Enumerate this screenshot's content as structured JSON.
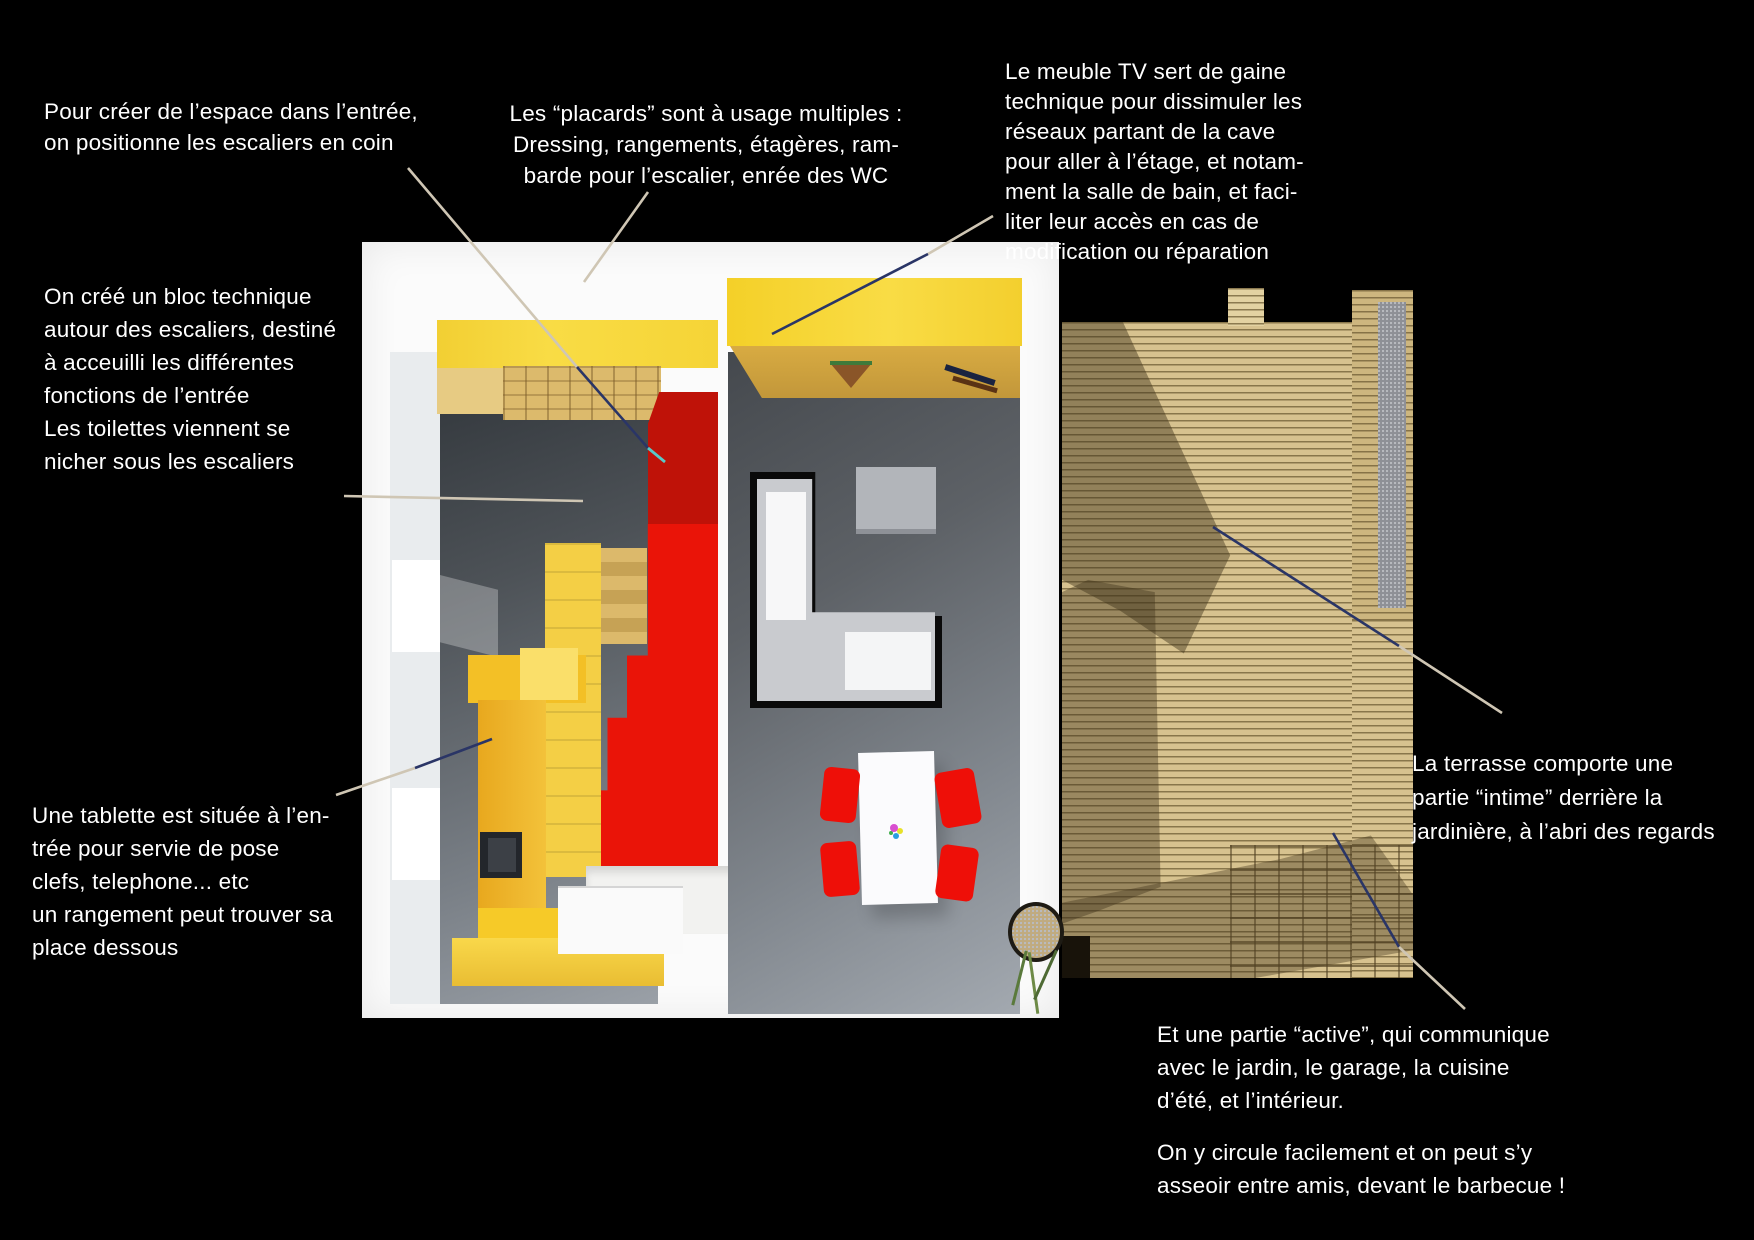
{
  "scene": {
    "description": "3D architectural floor-plan render (entrée, séjour, terrasse) on black background with annotation callouts",
    "background_color": "#000000",
    "annotation_text_color": "#ffffff"
  },
  "annotations": {
    "stairs_corner": {
      "text": "Pour créer de  l’espace dans l’entrée,\non positionne les escaliers en coin"
    },
    "placards": {
      "text": "Les “placards” sont à usage multiples :\nDressing, rangements, étagères, ram-\nbarde pour l’escalier, enrée des WC"
    },
    "meuble_tv": {
      "text": "Le meuble TV sert de gaine\ntechnique pour dissimuler les\nréseaux partant de la cave\npour aller à l’étage, et notam-\nment la salle de bain, et faci-\nliter leur accès en cas de\nmodification ou réparation"
    },
    "bloc_technique": {
      "text": "On créé un bloc technique\nautour des escaliers, destiné\nà acceuilli les différentes\nfonctions de l’entrée"
    },
    "toilettes": {
      "text": "Les toilettes viennent se\nnicher sous les escaliers"
    },
    "tablette": {
      "text": "Une tablette est située à l’en-\ntrée pour servie de pose\nclefs, telephone... etc\nun rangement peut trouver sa\nplace dessous"
    },
    "terrasse_intime": {
      "text": "La terrasse comporte une\npartie “intime” derrière la\njardinière, à l’abri des regards"
    },
    "partie_active": {
      "text": "Et une partie “active”, qui communique\navec le jardin, le garage, la cuisine\nd’été, et l’intérieur."
    },
    "circulation": {
      "text": "On y circule facilement et on peut s’y\nasseoir entre amis, devant le barbecue !"
    }
  },
  "palette": {
    "closet_yellow": "#f7d83a",
    "wood_tan": "#d8ab42",
    "stair_red_bright": "#ea1408",
    "stair_red_dark": "#bf1208",
    "chair_red": "#ee0f08",
    "floor_gray_dark": "#33383d",
    "floor_gray_light": "#9aa1a8",
    "kitchen_gray": "#c9cbcf",
    "terrace_wood": "#d7c28f",
    "leader_beige": "#cfc6b4",
    "leader_navy": "#2a3566",
    "leader_cyan": "#59c8c8"
  }
}
